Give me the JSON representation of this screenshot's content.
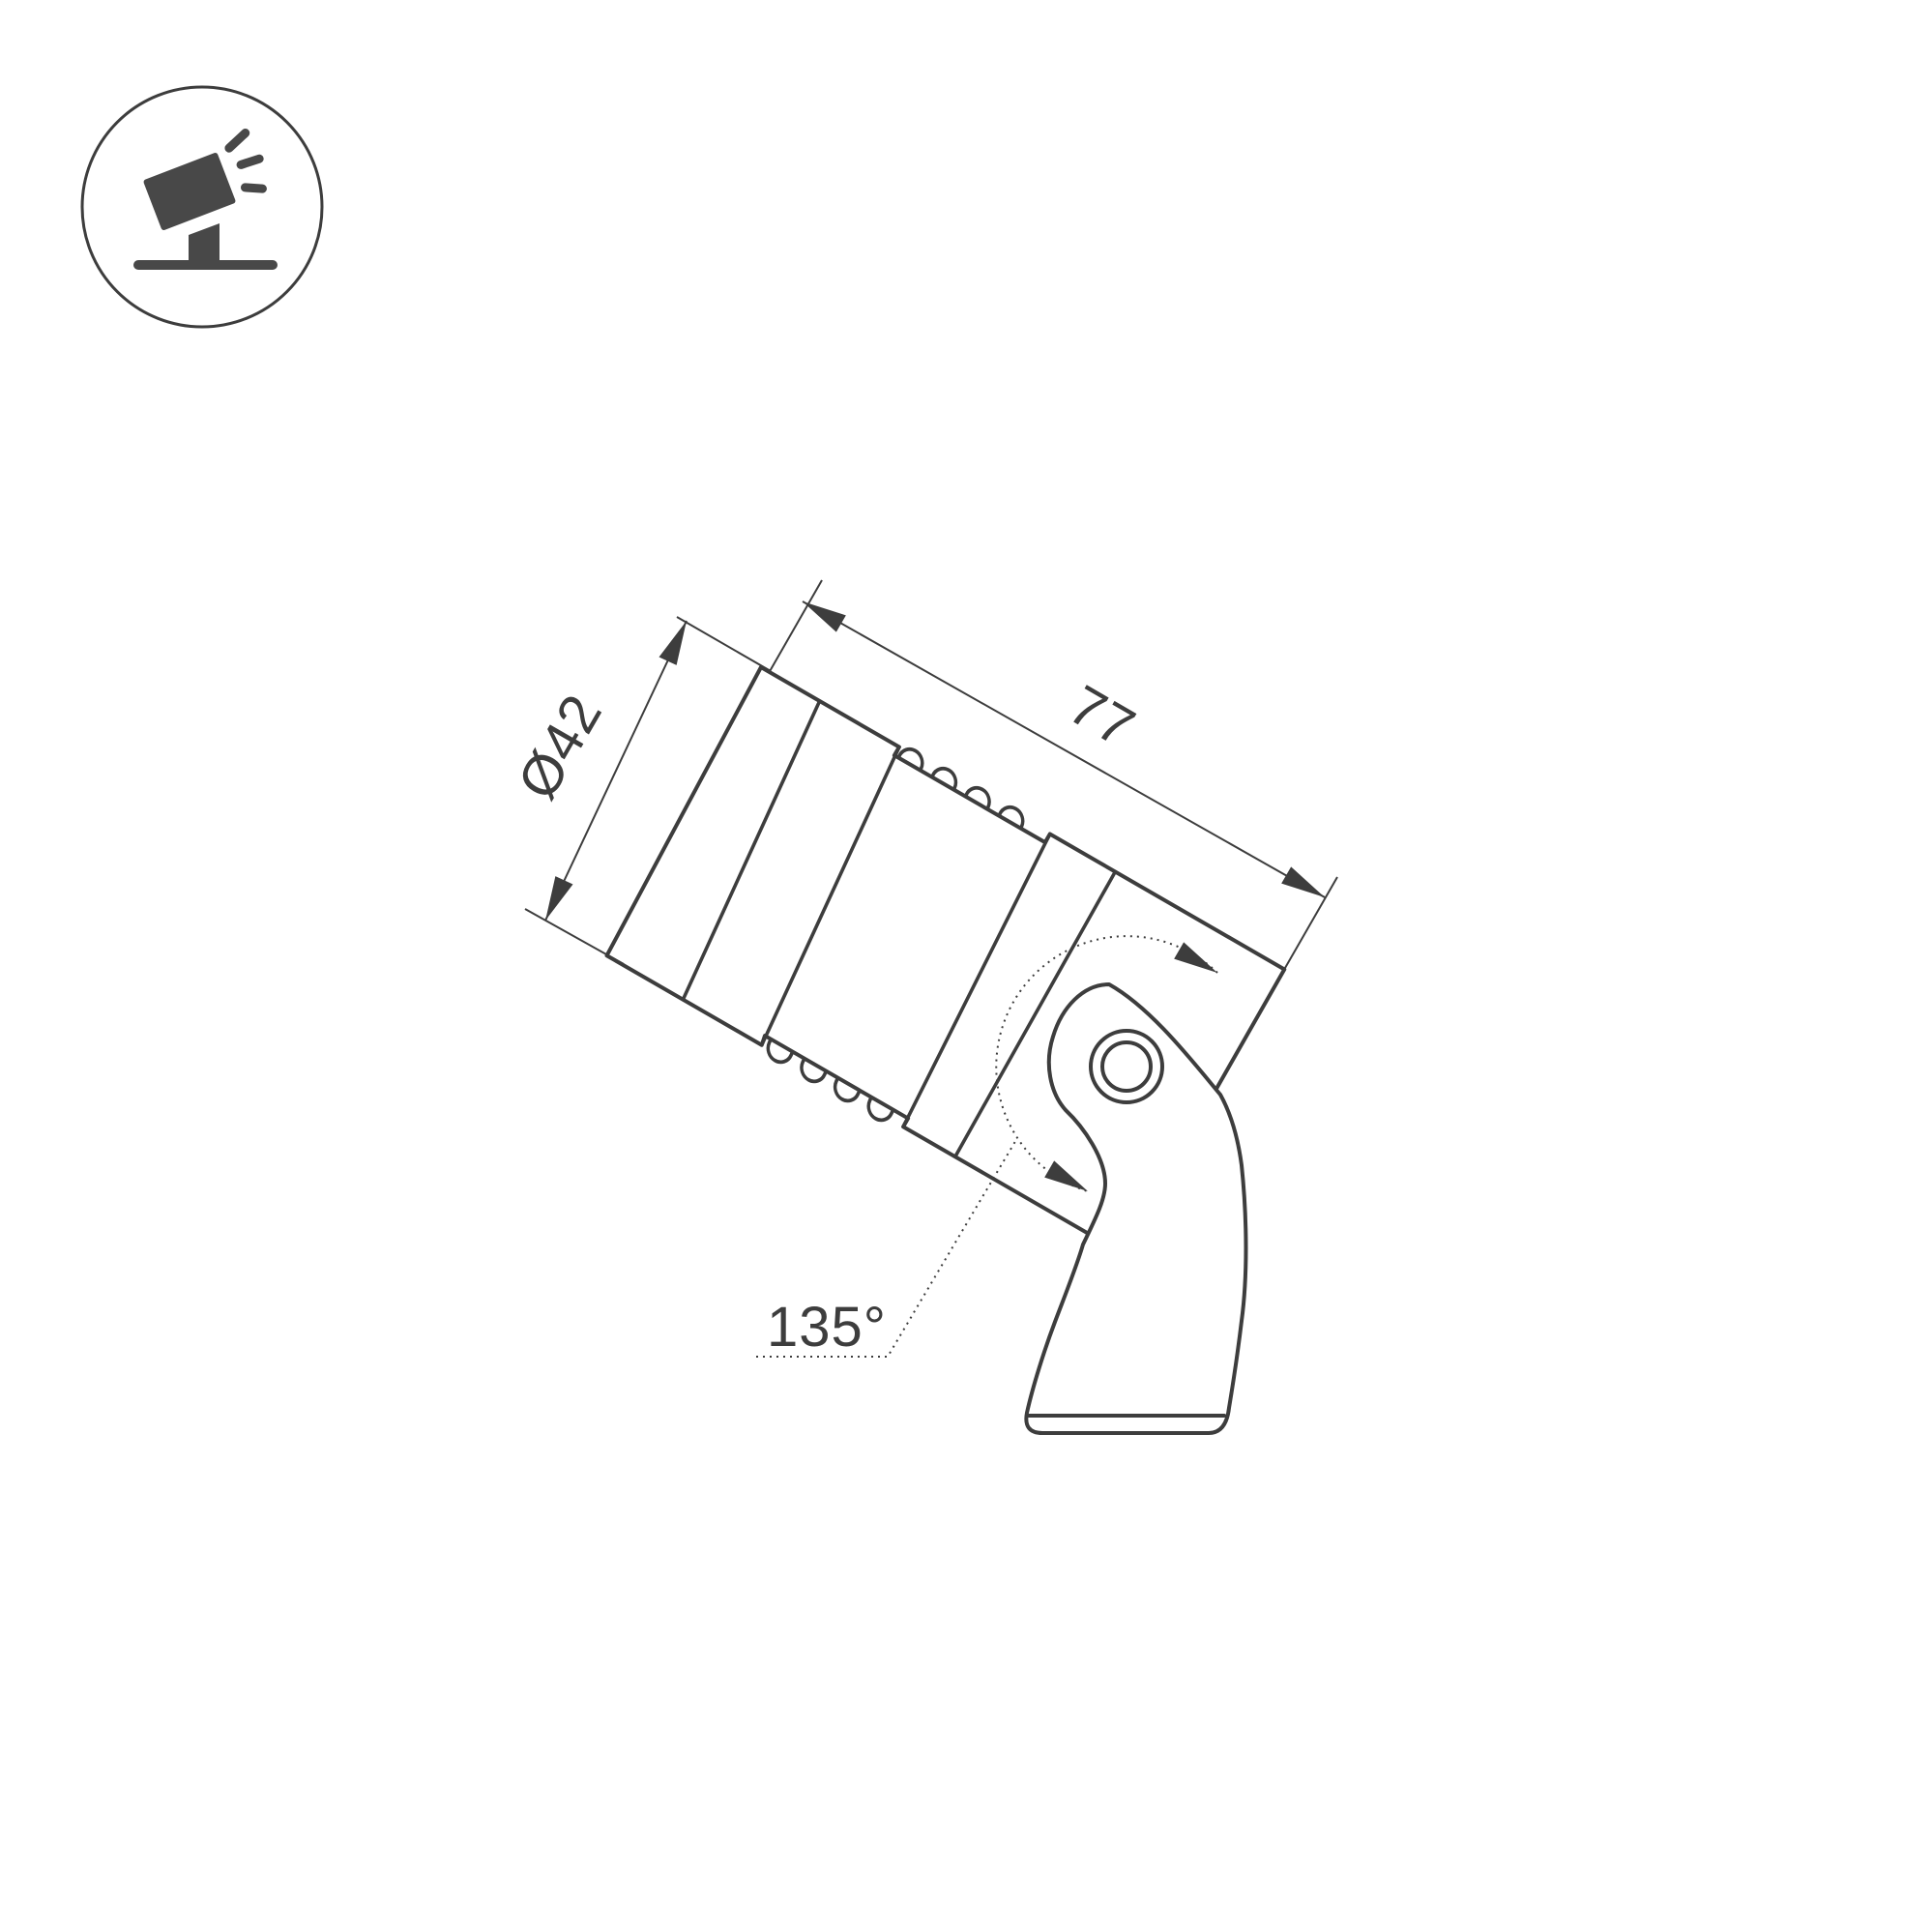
{
  "meta": {
    "type": "technical-dimension-drawing",
    "subject": "adjustable LED spotlight on mounting bracket, side view",
    "background_color": "#ffffff",
    "line_color": "#3d3d3d",
    "icon_fill_color": "#484848"
  },
  "icon": {
    "name": "tilted-spotlight-on-stand-icon",
    "description": "circled pictogram of a tilted spotlight emitting light rays, mounted on a stand"
  },
  "dimensions": {
    "diameter_label": "Ø42",
    "length_label": "77",
    "rotation_label": "135°"
  }
}
